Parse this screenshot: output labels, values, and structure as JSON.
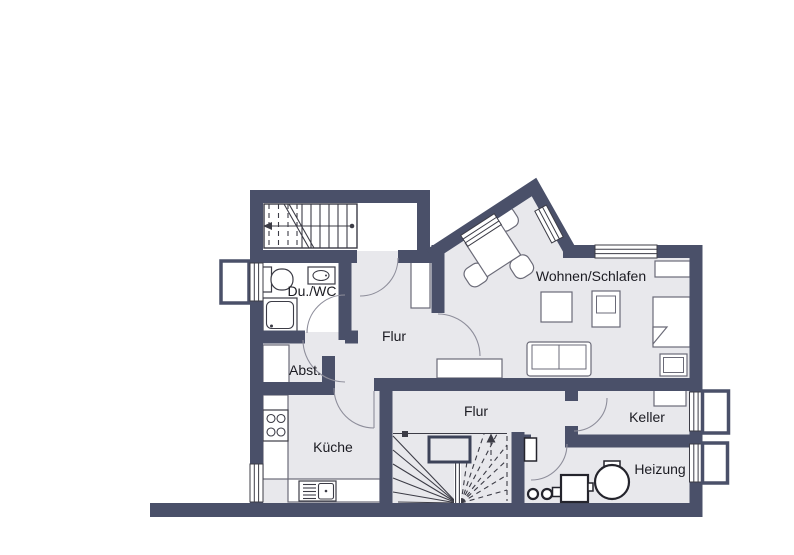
{
  "plan": {
    "title": "floor-plan-basement",
    "labels": {
      "du_wc": "Du./WC",
      "flur_upper": "Flur",
      "wohnen_schlafen": "Wohnen/Schlafen",
      "abst": "Abst.",
      "kueche": "Küche",
      "flur_lower": "Flur",
      "keller": "Keller",
      "heizung": "Heizung"
    },
    "rooms": [
      {
        "name": "Du./WC"
      },
      {
        "name": "Flur"
      },
      {
        "name": "Wohnen/Schlafen"
      },
      {
        "name": "Abst."
      },
      {
        "name": "Küche"
      },
      {
        "name": "Flur"
      },
      {
        "name": "Keller"
      },
      {
        "name": "Heizung"
      }
    ],
    "colors": {
      "wall": "#4a5069",
      "floor": "#e8e8ec",
      "background": "#ffffff",
      "door": "#8e8e9b",
      "line": "#3c3c46",
      "furniture": "#6b6b78"
    }
  }
}
